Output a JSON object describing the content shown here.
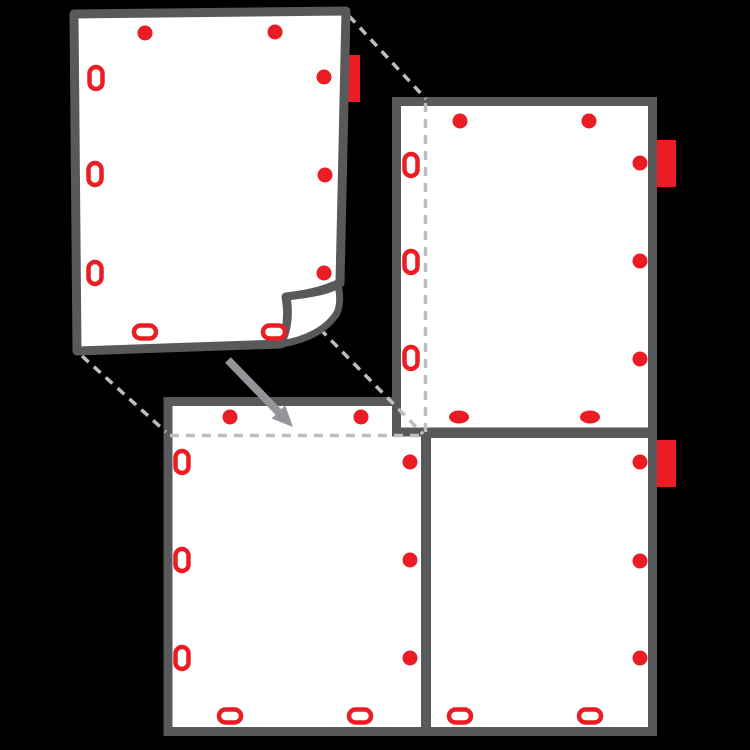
{
  "diagram": {
    "description": "tiled-poster-assembly-instruction-diagram",
    "canvas": {
      "width": 750,
      "height": 750,
      "background": "#000000"
    },
    "colors": {
      "sheet_fill": "#FFFFFF",
      "sheet_border": "#58595B",
      "marker_red": "#EC1C24",
      "guide_gray": "#BCBEC0",
      "arrow_gray": "#939598"
    },
    "style": {
      "sheet_stroke_width": 9,
      "flap_stroke_width": 7,
      "guide_stroke_width": 3.5,
      "guide_dash": "9 7",
      "dot_radius": 7.5,
      "slot_vertical_size": [
        13,
        22
      ],
      "slot_horizontal_size": [
        22,
        13
      ],
      "solid_ellipse_radii": [
        10,
        6.5
      ],
      "marker_ring_stroke": 4.5,
      "arrow_shaft_width": 8
    },
    "sheets": [
      {
        "id": "bottom-left-sheet",
        "kind": "flat",
        "rect": {
          "x": 168,
          "y": 401.5,
          "w": 257.5,
          "h": 330
        },
        "dots": [
          [
            230,
            417
          ],
          [
            361,
            417
          ],
          [
            410,
            462
          ],
          [
            410,
            560
          ],
          [
            410,
            658
          ]
        ],
        "slots_vertical": [
          [
            182,
            462
          ],
          [
            182,
            560
          ],
          [
            182,
            658
          ]
        ],
        "slots_horizontal": [
          [
            230,
            716
          ],
          [
            360,
            716
          ]
        ],
        "solid_ellipses": [],
        "tab": null,
        "overlap_guide": {
          "type": "horizontal",
          "y": 435.5,
          "x1": 170,
          "x2": 426
        }
      },
      {
        "id": "bottom-right-sheet",
        "kind": "flat",
        "rect": {
          "x": 426.5,
          "y": 433.5,
          "w": 226,
          "h": 298
        },
        "dots": [
          [
            640,
            462
          ],
          [
            640,
            561
          ],
          [
            640,
            658
          ]
        ],
        "slots_vertical": [],
        "slots_horizontal": [
          [
            460,
            716
          ],
          [
            590,
            716
          ]
        ],
        "solid_ellipses": [],
        "tab": {
          "x": 650,
          "y": 440,
          "w": 26,
          "h": 47
        },
        "overlap_guide": null
      },
      {
        "id": "top-right-sheet",
        "kind": "flat",
        "rect": {
          "x": 396.5,
          "y": 101.5,
          "w": 256,
          "h": 330.5
        },
        "dots": [
          [
            460,
            121
          ],
          [
            589,
            121
          ],
          [
            640,
            163
          ],
          [
            640,
            261
          ],
          [
            640,
            359
          ]
        ],
        "slots_vertical": [
          [
            411,
            165
          ],
          [
            411,
            262
          ],
          [
            411,
            358
          ]
        ],
        "slots_horizontal": [],
        "solid_ellipses": [
          [
            459,
            417
          ],
          [
            590,
            417
          ]
        ],
        "tab": {
          "x": 650,
          "y": 140,
          "w": 26,
          "h": 47
        },
        "overlap_guide": {
          "type": "vertical",
          "x": 425.5,
          "y1": 103,
          "y2": 433
        }
      },
      {
        "id": "lifted-sheet",
        "kind": "lifted",
        "body_path": "M 74 14 L 346 11 L 340 283 C 322 292 302 295 286 297 C 289 314 288 330 281 344 L 77 351 Z",
        "flap_path": "M 338 285 C 327 292 305 295 287 297 C 290 314 288 331 281 344 C 307 340 327 329 337 313 C 341 304 340 294 338 285 Z",
        "dots": [
          [
            145,
            33
          ],
          [
            275,
            32
          ],
          [
            324,
            77
          ],
          [
            325,
            175
          ],
          [
            324,
            273
          ]
        ],
        "slots_vertical": [
          [
            96,
            78
          ],
          [
            95,
            174
          ],
          [
            95,
            273
          ]
        ],
        "slots_horizontal": [
          [
            145,
            332
          ],
          [
            274,
            332
          ]
        ],
        "solid_ellipses": [],
        "tab": {
          "x": 340,
          "y": 55,
          "w": 20,
          "h": 47
        },
        "overlap_guide": null
      }
    ],
    "projection_lines": [
      {
        "from": [
          349,
          16
        ],
        "to": [
          426,
          99
        ]
      },
      {
        "from": [
          82,
          356
        ],
        "to": [
          166,
          432
        ]
      },
      {
        "from": [
          320,
          329
        ],
        "to": [
          423,
          434
        ]
      }
    ],
    "arrow": {
      "from": [
        228,
        360
      ],
      "to": [
        293,
        427
      ],
      "head_length": 21,
      "head_width": 19
    }
  }
}
